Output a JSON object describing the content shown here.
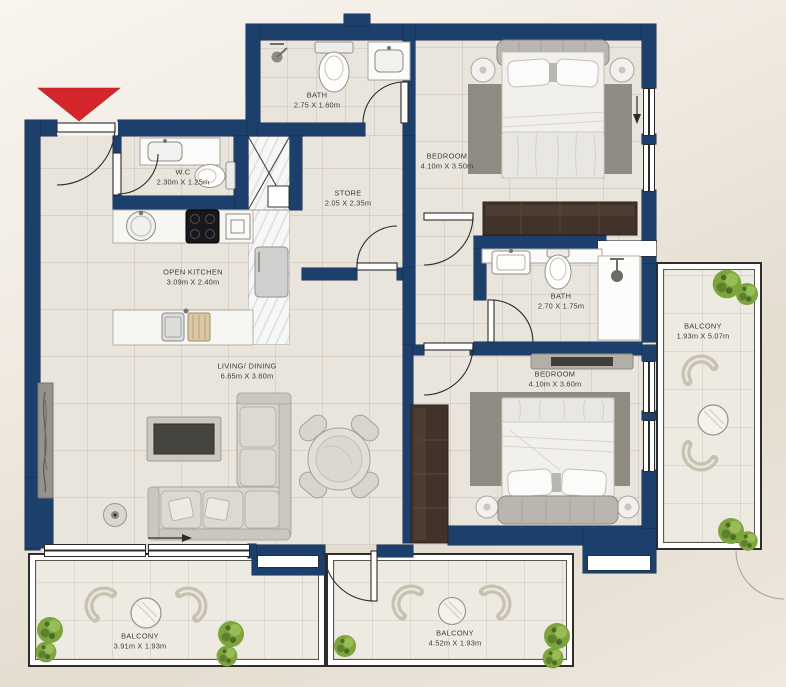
{
  "plan": {
    "wall_color": "#1c3f6c",
    "entrance_marker": {
      "shape": "triangle-down",
      "color": "#d5262b"
    },
    "rooms": [
      {
        "id": "bath-1",
        "name": "BATH",
        "dims": "2.75 X 1.60m"
      },
      {
        "id": "bedroom-1",
        "name": "BEDROOM",
        "dims": "4.10m X 3.50m"
      },
      {
        "id": "wc",
        "name": "W.C",
        "dims": "2.30m X 1.25m"
      },
      {
        "id": "store",
        "name": "STORE",
        "dims": "2.05 X 2.35m"
      },
      {
        "id": "open-kitchen",
        "name": "OPEN KITCHEN",
        "dims": "3.09m X 2.40m"
      },
      {
        "id": "bath-2",
        "name": "BATH",
        "dims": "2.70 X 1.75m"
      },
      {
        "id": "balcony-right",
        "name": "BALCONY",
        "dims": "1.93m X 5.07m"
      },
      {
        "id": "bedroom-2",
        "name": "BEDROOM",
        "dims": "4.10m X 3.60m"
      },
      {
        "id": "living-dining",
        "name": "LIVING/ DINING",
        "dims": "6.65m X 3.60m"
      },
      {
        "id": "balcony-bottom-left",
        "name": "BALCONY",
        "dims": "3.91m X 1.93m"
      },
      {
        "id": "balcony-bottom-center",
        "name": "BALCONY",
        "dims": "4.52m X 1.93m"
      }
    ]
  }
}
